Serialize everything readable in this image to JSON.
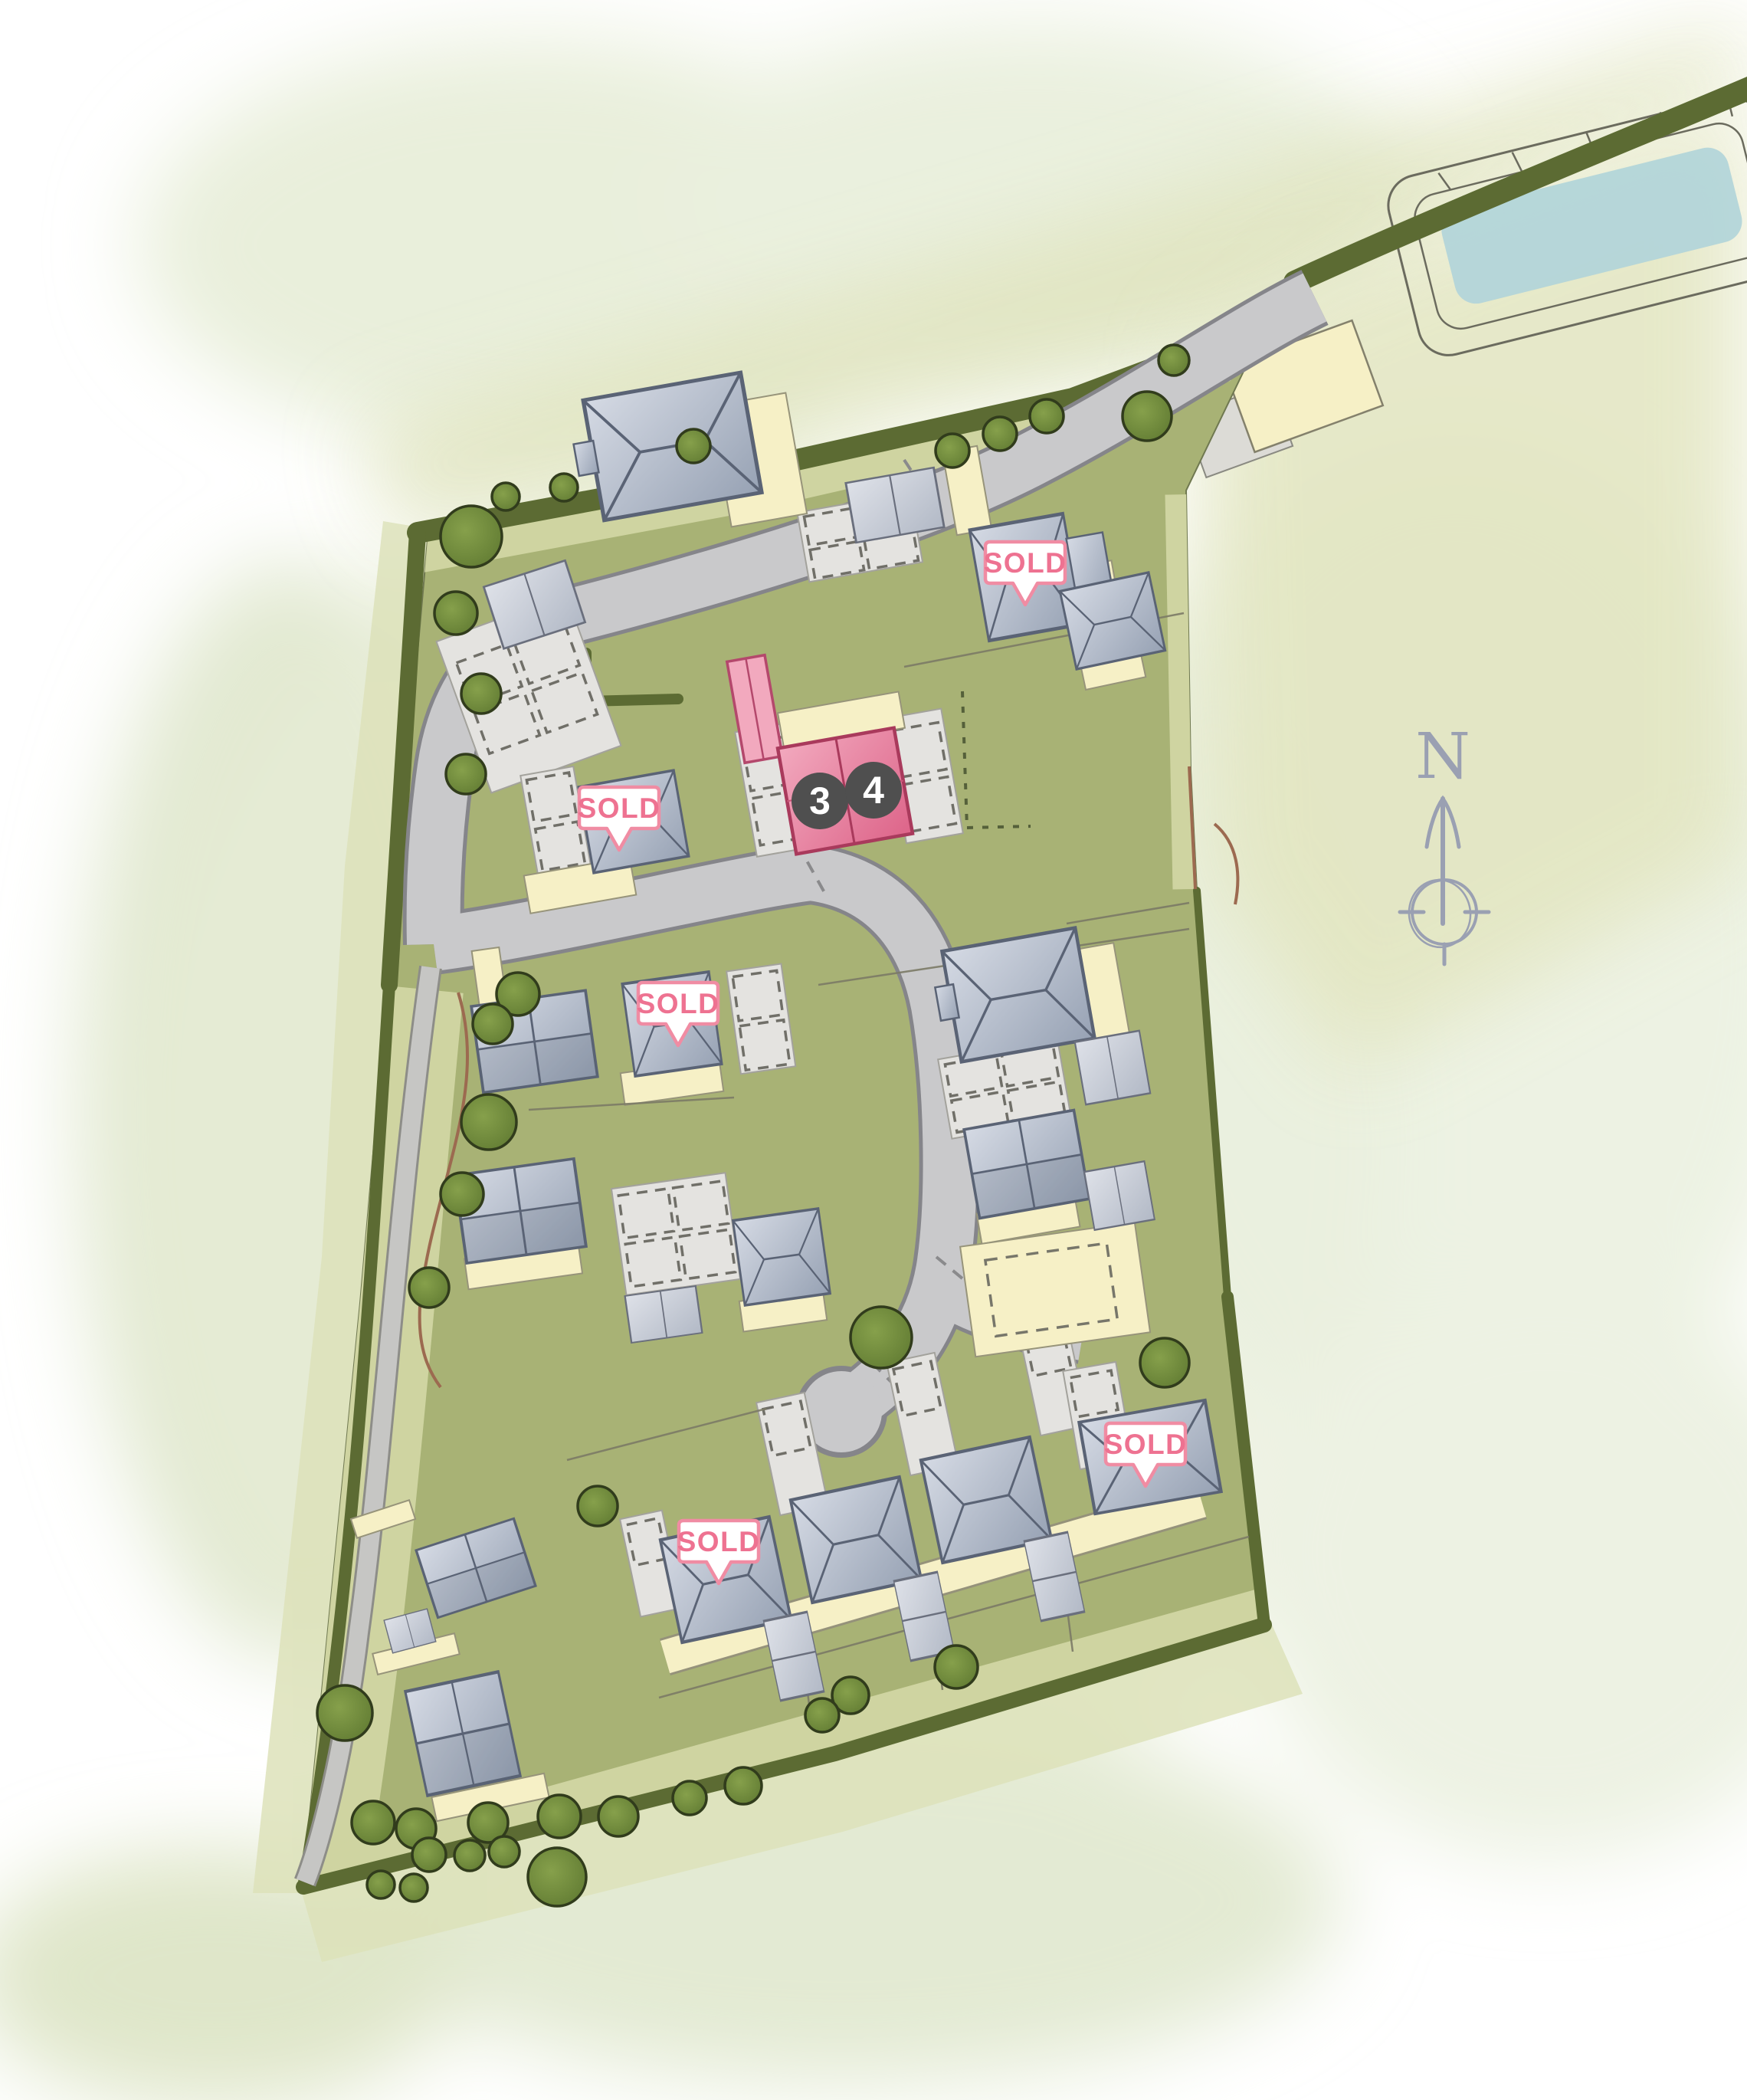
{
  "compass": {
    "label": "N"
  },
  "badges": {
    "sold": [
      {
        "label": "SOLD"
      },
      {
        "label": "SOLD"
      },
      {
        "label": "SOLD"
      },
      {
        "label": "SOLD"
      },
      {
        "label": "SOLD"
      }
    ]
  },
  "plot_markers": [
    {
      "number": "3",
      "status": "available"
    },
    {
      "number": "4",
      "status": "available"
    }
  ],
  "palette": {
    "grass": "#a8b275",
    "verge": "#cfd4a1",
    "meadow": "#e0e4bf",
    "hedge": "#5c6b33",
    "tree": "#76903c",
    "road": "#c9c9cb",
    "road_edge": "#85858a",
    "driveway": "#e4e3e0",
    "parking_dash": "#706f68",
    "roof_light": "#d5dae4",
    "roof_dark": "#97a2b4",
    "roof_outline": "#5a6375",
    "patio_cream": "#f6f0c6",
    "pond_water": "#b3d5d9",
    "plot_highlight": "#dd6489",
    "plot_highlight_light": "#f2a9be",
    "badge_border": "#f08ca3",
    "badge_text": "#ee7291",
    "marker_bg": "#4f4f4f",
    "marker_text": "#ffffff",
    "compass_gray": "#9aa0b2",
    "fence_brown": "#9c6a50"
  }
}
